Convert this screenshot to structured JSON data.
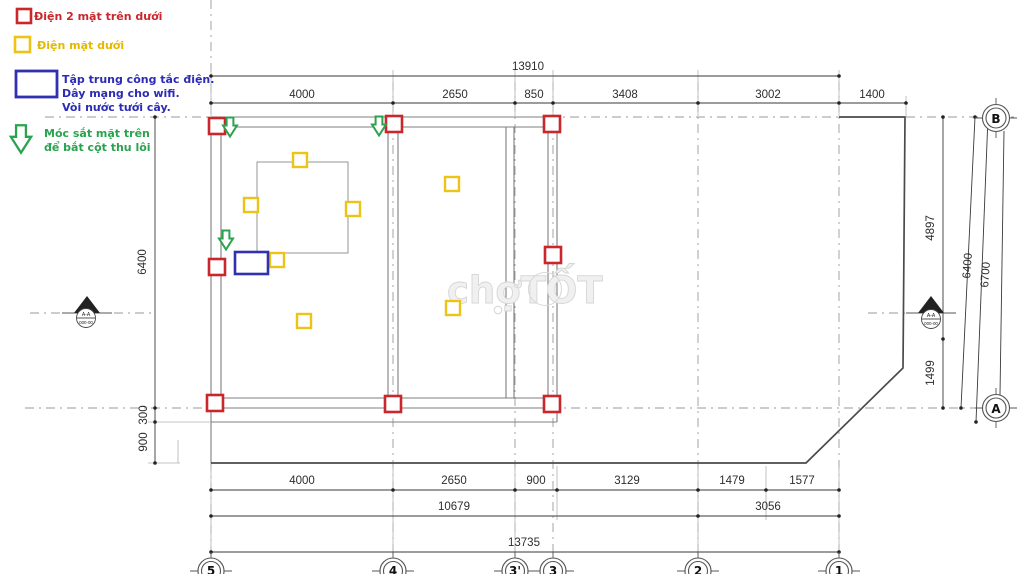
{
  "legend": {
    "items": [
      {
        "symbol": "red-square",
        "label": "Điện 2 mặt trên dưới"
      },
      {
        "symbol": "yellow-square",
        "label": "Điện mặt dưới"
      },
      {
        "symbol": "blue-rectangle",
        "lines": [
          "Tập trung công tắc điện.",
          "Dây mạng cho wifi.",
          "Vòi nước tưới cây."
        ]
      },
      {
        "symbol": "green-arrow",
        "lines": [
          "Móc sắt mặt trên",
          "để bắt cột thu lôi"
        ]
      }
    ]
  },
  "dims": {
    "top_total": "13910",
    "top": [
      "4000",
      "2650",
      "850",
      "3408",
      "3002",
      "1400"
    ],
    "bottom": [
      "4000",
      "2650",
      "900",
      "3129",
      "1479",
      "1577"
    ],
    "bottom_sub": [
      "10679",
      "3056"
    ],
    "bottom_total": "13735",
    "left": [
      "6400",
      "300",
      "900"
    ],
    "right": [
      "4897",
      "1499",
      "6400",
      "6700"
    ]
  },
  "grid": {
    "bottom_bubbles": [
      "5",
      "4",
      "3'",
      "3",
      "2",
      "1"
    ],
    "right_bubbles": [
      "B",
      "A"
    ]
  },
  "section_marker": {
    "label": "A-A",
    "sheet": "000-00"
  },
  "watermark": {
    "text": "chợTỐT"
  },
  "colors": {
    "red": "#c9272c",
    "yellow": "#ebc417",
    "blue": "#3030b0",
    "green": "#2aa34f"
  },
  "symbols": {
    "red_columns": [
      {
        "x": 217,
        "y": 126
      },
      {
        "x": 394,
        "y": 124
      },
      {
        "x": 552,
        "y": 124
      },
      {
        "x": 217,
        "y": 267
      },
      {
        "x": 553,
        "y": 255
      },
      {
        "x": 215,
        "y": 403
      },
      {
        "x": 393,
        "y": 404
      },
      {
        "x": 552,
        "y": 404
      }
    ],
    "yellow_outlets": [
      {
        "x": 300,
        "y": 160
      },
      {
        "x": 251,
        "y": 205
      },
      {
        "x": 353,
        "y": 209
      },
      {
        "x": 277,
        "y": 260
      },
      {
        "x": 304,
        "y": 321
      },
      {
        "x": 452,
        "y": 184
      },
      {
        "x": 453,
        "y": 308
      }
    ],
    "green_hooks": [
      {
        "x": 230,
        "y": 127
      },
      {
        "x": 379,
        "y": 126
      },
      {
        "x": 226,
        "y": 240
      }
    ],
    "blue_panel": {
      "x": 235,
      "y": 252,
      "w": 33,
      "h": 22
    }
  }
}
